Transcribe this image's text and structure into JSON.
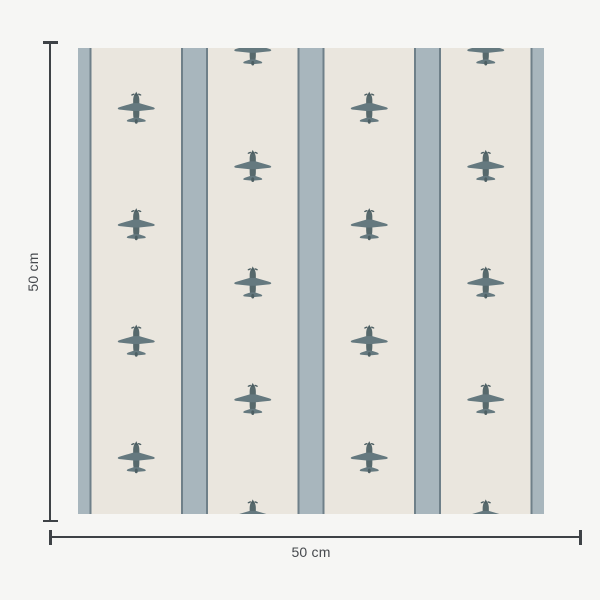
{
  "page": {
    "background_color": "#f6f6f4"
  },
  "figure": {
    "name": "airplane-stripe-wallpaper-swatch",
    "height_label": "50 cm",
    "width_label": "50 cm"
  },
  "pattern": {
    "motif": "vintage-airplane-top-view",
    "background_color": "#eae6de",
    "stripe_fill_color": "#a8b6bd",
    "stripe_edge_color": "#6f8089",
    "plane_wing_color": "#65797f",
    "plane_body_color": "#57696c",
    "plane_detail_color": "#4d5f63",
    "swatch_width_px": 466,
    "swatch_height_px": 466,
    "tile_size_px": 116.5,
    "stripe_width_px": 27,
    "stripe_edge_px": 2,
    "edge_half_stripe_px": 13.5,
    "columns": 4,
    "rows_half_drop_column": 4,
    "rows_grid_column": 5,
    "plane_width_px": 40,
    "plane_height_px": 36
  },
  "annotation": {
    "line_color": "#3e4246",
    "text_color": "#46494d"
  }
}
